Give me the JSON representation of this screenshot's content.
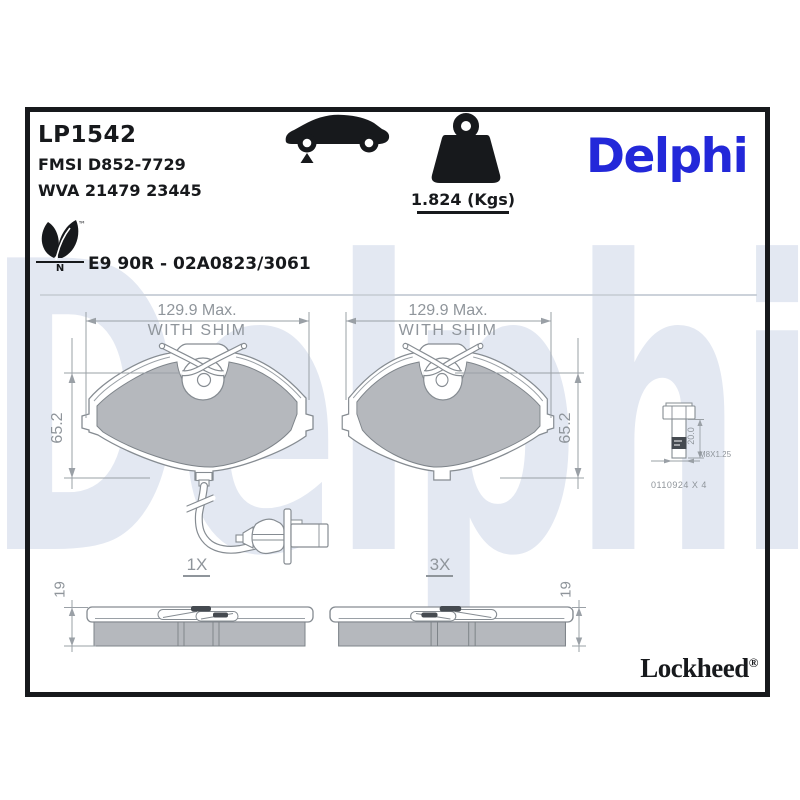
{
  "header": {
    "part_number": "LP1542",
    "fmsi_line": "FMSI D852-7729",
    "wva_line": "WVA 21479 23445",
    "homologation_line": "E9 90R - 02A0823/3061",
    "weight_value": "1.824 (Kgs)",
    "eco_leaf_tm": "™",
    "eco_leaf_letter": "N"
  },
  "brand": {
    "logo_text": "Delphi",
    "watermark_text": "Delphi",
    "footer_brand": "Lockheed",
    "footer_registered": "®"
  },
  "drawing": {
    "front_views": [
      {
        "width_dim": "129.9 Max.",
        "width_note": "WITH SHIM",
        "height_dim": "65.2",
        "quantity": "1X"
      },
      {
        "width_dim": "129.9 Max.",
        "width_note": "WITH SHIM",
        "height_dim": "65.2",
        "quantity": "3X"
      }
    ],
    "side_views": [
      {
        "thickness_dim": "19"
      },
      {
        "thickness_dim": "19"
      }
    ],
    "hardware_bolt": {
      "shank_length_dim": "20.0",
      "thread_spec": "M8X1.25",
      "reference": "0110924 X 4"
    }
  },
  "icons": {
    "car": "car-silhouette-front-axle-marker",
    "weight": "kettlebell-weight",
    "eco": "leaf-plant"
  },
  "colors": {
    "accent_blue": "#2328d9",
    "watermark_blue": "#e3e8f2",
    "friction_gray": "#b5b8bd",
    "linework_gray": "#8f959b",
    "ink_black": "#17191c"
  }
}
